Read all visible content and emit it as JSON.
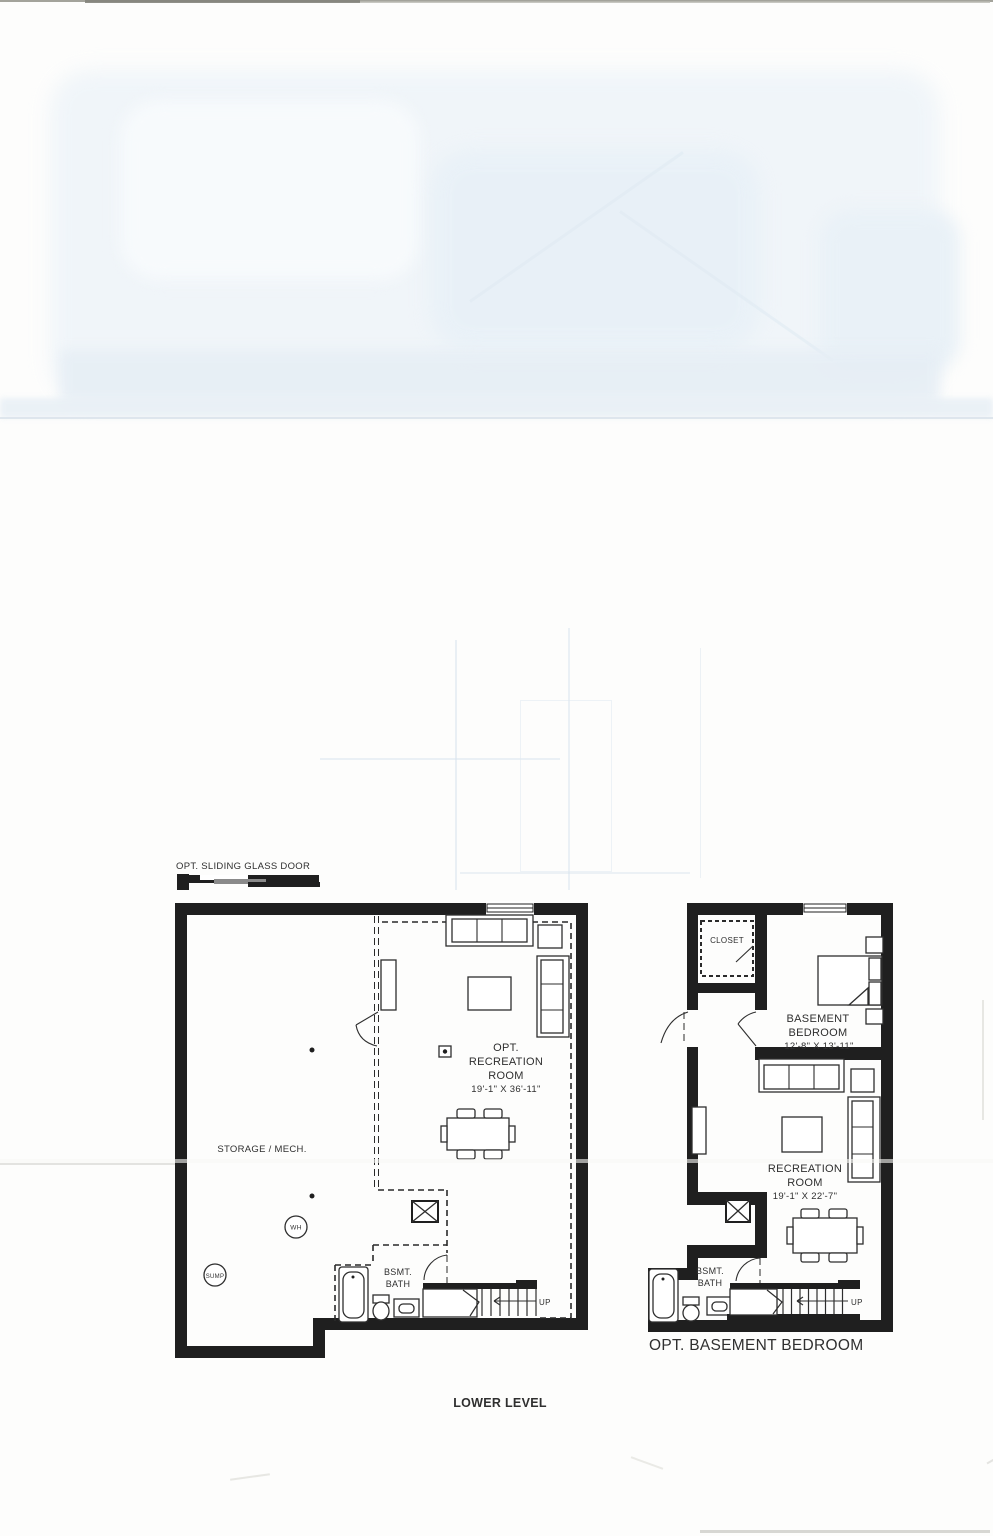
{
  "document": {
    "level_caption": "LOWER LEVEL",
    "right_plan_caption": "OPT. BASEMENT BEDROOM"
  },
  "left_plan": {
    "sliding_door_label": "OPT. SLIDING GLASS DOOR",
    "recreation_room": {
      "l1": "OPT.",
      "l2": "RECREATION",
      "l3": "ROOM",
      "dims": "19'-1\" X 36'-11\""
    },
    "storage_label": "STORAGE / MECH.",
    "water_heater_label": "WH",
    "sump_label": "SUMP",
    "bath": {
      "l1": "BSMT.",
      "l2": "BATH"
    },
    "stairs_label": "UP"
  },
  "right_plan": {
    "closet_label": "CLOSET",
    "bedroom": {
      "l1": "BASEMENT",
      "l2": "BEDROOM",
      "dims": "12'-8\" X 13'-11\""
    },
    "recreation_room": {
      "l1": "RECREATION",
      "l2": "ROOM",
      "dims": "19'-1\" X 22'-7\""
    },
    "bath": {
      "l1": "BSMT.",
      "l2": "BATH"
    },
    "stairs_label": "UP"
  },
  "colors": {
    "wall": "#1f1f1f",
    "caption_blue": "#3d5a73"
  }
}
